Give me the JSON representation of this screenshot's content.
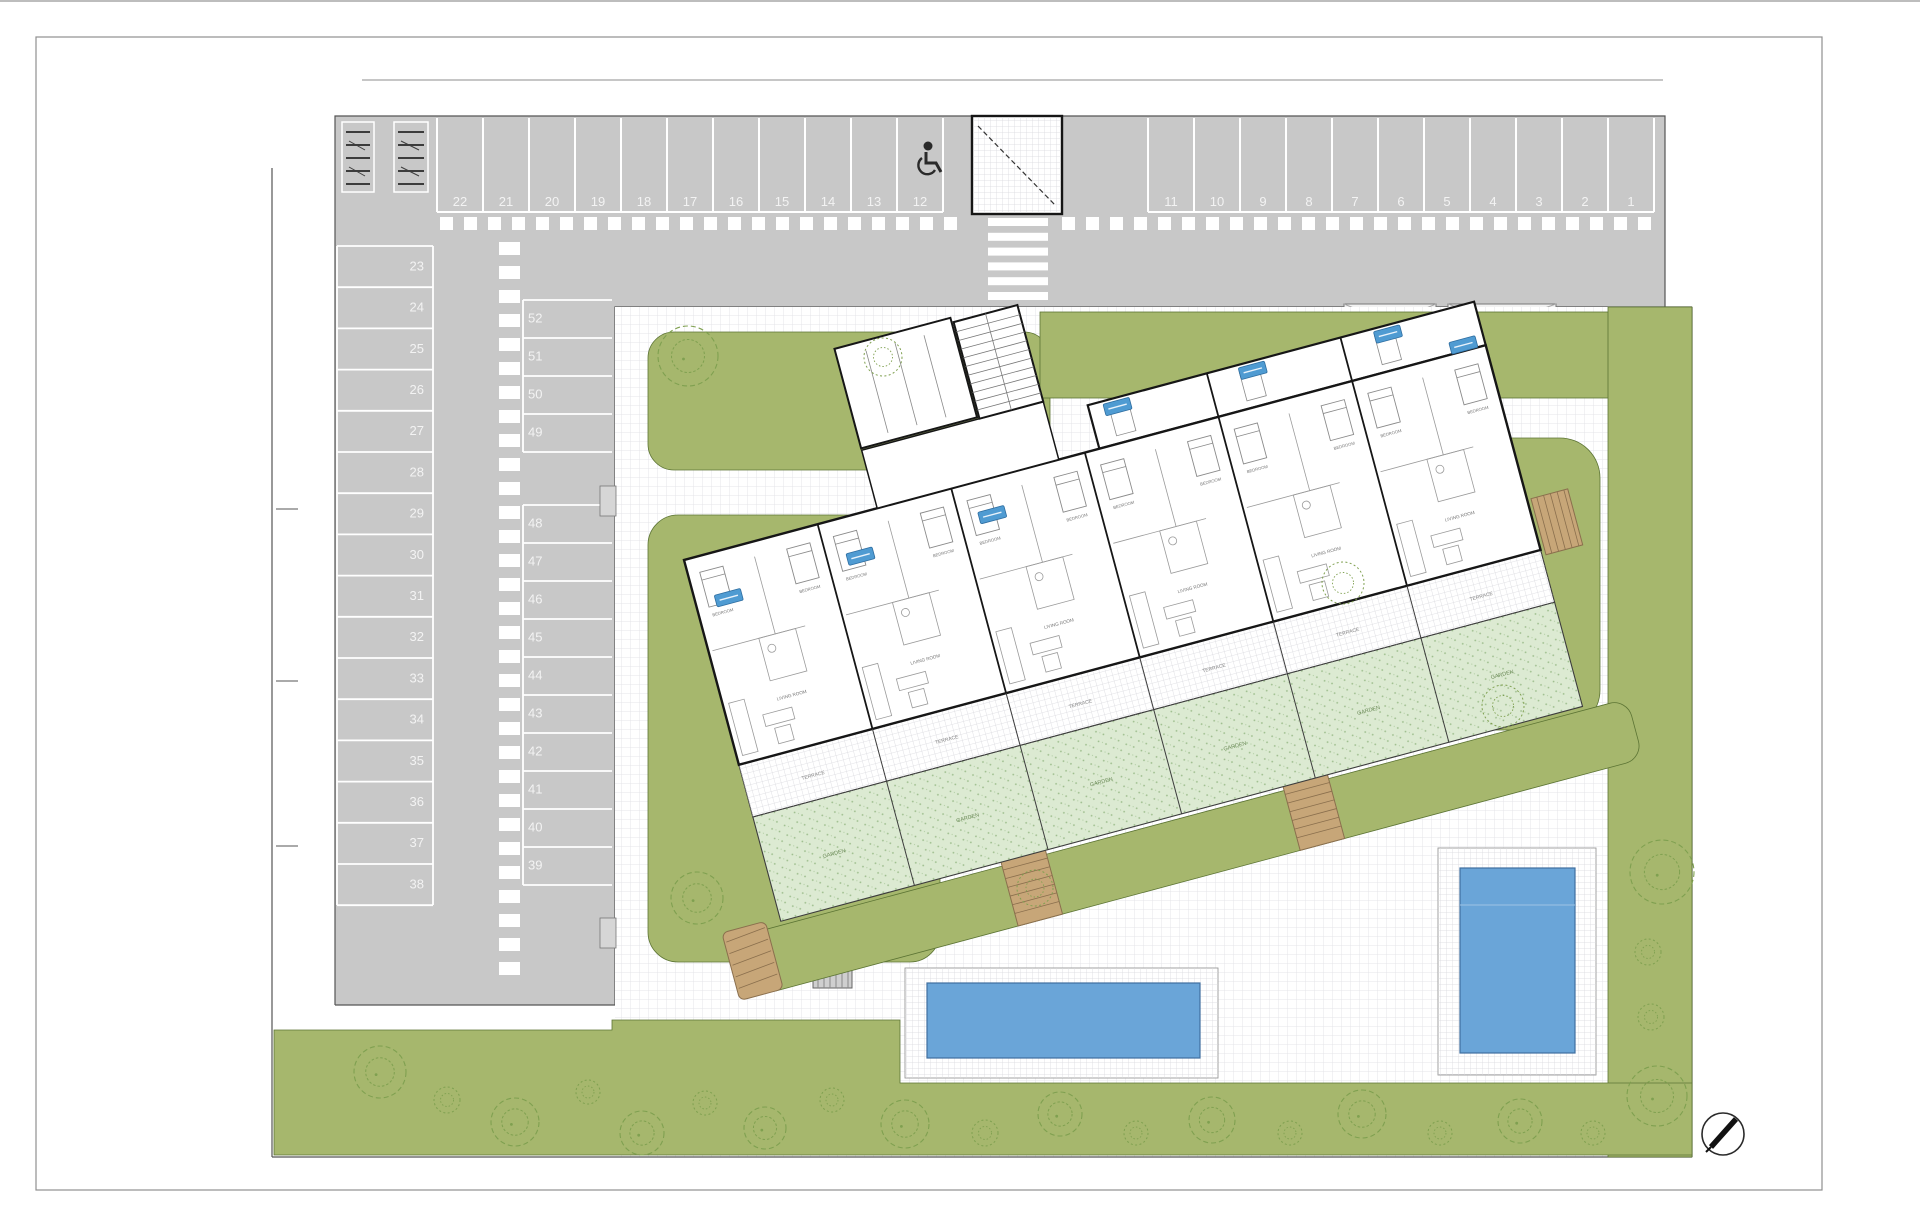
{
  "parking": {
    "top_row_left": [
      "22",
      "21",
      "20",
      "19",
      "18",
      "17",
      "16",
      "15",
      "14",
      "13",
      "12"
    ],
    "top_row_right": [
      "11",
      "10",
      "9",
      "8",
      "7",
      "6",
      "5",
      "4",
      "3",
      "2",
      "1"
    ],
    "left_column": [
      "23",
      "24",
      "25",
      "26",
      "27",
      "28",
      "29",
      "30",
      "31",
      "32",
      "33",
      "34",
      "35",
      "36",
      "37",
      "38"
    ],
    "middle_column_upper": [
      "52",
      "51",
      "50",
      "49"
    ],
    "middle_column_lower": [
      "48",
      "47",
      "46",
      "45",
      "44",
      "43",
      "42",
      "41",
      "40",
      "39"
    ]
  },
  "building": {
    "units": 6,
    "labels": {
      "bedroom": "BEDROOM",
      "living": "LIVING ROOM",
      "terrace": "TERRACE",
      "garden": "GARDEN"
    }
  },
  "icons": {
    "wheelchair": "wheelchair-accessible-parking-icon",
    "compass": "north-arrow-icon",
    "bike_rack": "bike-rack-icon",
    "tree": "tree-icon"
  },
  "colors": {
    "asphalt": "#c8c8c8",
    "stall_line": "#ffffff",
    "lawn": "#a6b76d",
    "lawn_edge": "#5c7434",
    "garden_hatch": "#dcead2",
    "pool": "#6aa5d8",
    "pool_edge": "#3f6f9f",
    "wood": "#c7a678",
    "wood_edge": "#8a6f4d",
    "unit_tag": "#4f9bd2",
    "wall": "#161616"
  }
}
